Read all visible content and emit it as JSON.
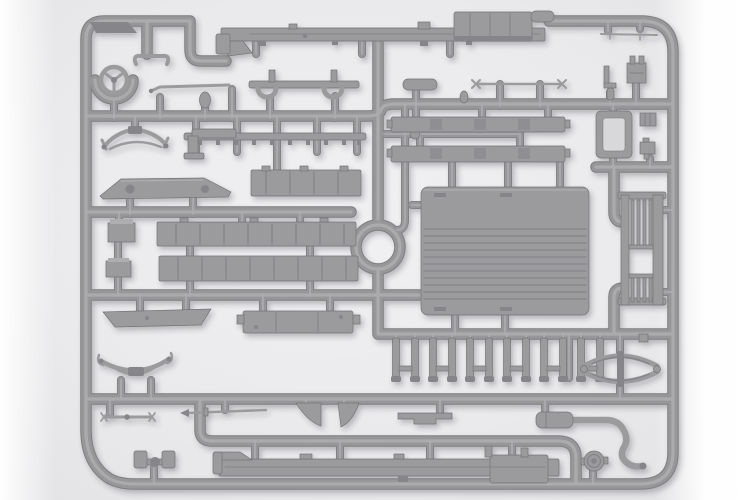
{
  "meta": {
    "title": "Model kit sprue — grey styrene parts frame (truck chassis details)",
    "type": "product-photo",
    "text_on_screen": "none"
  },
  "colors": {
    "runner-mid": "#97979a",
    "runner-edge": "#7e7e82",
    "runner-highlight": "#aeaeb1",
    "part": "#9b9b9e",
    "part-dark": "#85858a",
    "part-light": "#aeaeb0",
    "part-edge": "#747478",
    "hole": "#d8d8db",
    "background": "#eaeaec",
    "page": "#ffffff",
    "shadow": "rgba(50,50,60,0.28)"
  },
  "sprue": {
    "material": "grey injection-molded styrene",
    "stake_count": 12,
    "parts": [
      {
        "name": "sprue-frame",
        "label": "Rectangular runner frame with internal runners"
      },
      {
        "name": "steering-wheel",
        "label": "Steering wheel (3-spoke) in U-holder"
      },
      {
        "name": "control-lever",
        "label": "Control lever with curled ends"
      },
      {
        "name": "thin-rod-upper",
        "label": "Thin linkage rod"
      },
      {
        "name": "hook-bracket",
        "label": "Bracket strip with hanging hooks"
      },
      {
        "name": "small-oval",
        "label": "Small oval fitting"
      },
      {
        "name": "ladder-rail",
        "label": "Thin rail with tabs"
      },
      {
        "name": "l-bracket",
        "label": "L-shaped pedal bracket"
      },
      {
        "name": "front-leaf-spring",
        "label": "Curved leaf spring (front)"
      },
      {
        "name": "fender",
        "label": "Fender / mudguard plate with two holes"
      },
      {
        "name": "tool-box-1",
        "label": "Small storage box"
      },
      {
        "name": "tool-box-2",
        "label": "Small storage box"
      },
      {
        "name": "bed-side-short",
        "label": "Cargo bed side board (short)"
      },
      {
        "name": "bed-side-long-1",
        "label": "Cargo bed side board (long)"
      },
      {
        "name": "bed-side-long-2",
        "label": "Cargo bed side board (long)"
      },
      {
        "name": "bed-floor-panel",
        "label": "Cargo bed floor panel with plank grooves"
      },
      {
        "name": "radiator-frame",
        "label": "Open radiator shell frame"
      },
      {
        "name": "small-fitting-1",
        "label": "Small fitting"
      },
      {
        "name": "small-fitting-2",
        "label": "Small fitting with leg"
      },
      {
        "name": "tailgate-rack",
        "label": "Slatted tailgate / rack panel"
      },
      {
        "name": "stake-posts",
        "label": "Row of twelve stake posts"
      },
      {
        "name": "rear-leaf-spring",
        "label": "Elliptical leaf spring (rear)"
      },
      {
        "name": "left-leaf-spring",
        "label": "Curved leaf spring with shackles"
      },
      {
        "name": "step-plate",
        "label": "Running-board step plate"
      },
      {
        "name": "center-sill",
        "label": "Bench / sill box part"
      },
      {
        "name": "chassis-rail-upper",
        "label": "Chassis side rail (top of sprue)"
      },
      {
        "name": "fuel-tank-box",
        "label": "Fuel tank / muffler box"
      },
      {
        "name": "chassis-rail-lower",
        "label": "Chassis side rail (bottom of sprue)"
      },
      {
        "name": "gusset-pair",
        "label": "Two triangular gussets"
      },
      {
        "name": "notched-bracket",
        "label": "Flat notched bracket"
      },
      {
        "name": "tie-rod-left",
        "label": "Tie rod with forged ends"
      },
      {
        "name": "tie-rod-center",
        "label": "Thin rod with arrow end"
      },
      {
        "name": "axle-rod-right",
        "label": "Axle rod with cross finials"
      },
      {
        "name": "steering-cylinder",
        "label": "Small cylinder part"
      },
      {
        "name": "running-board-1",
        "label": "Running board plank"
      },
      {
        "name": "running-board-2",
        "label": "Running board plank"
      },
      {
        "name": "muffler-exhaust",
        "label": "Muffler with S-curved exhaust pipe"
      },
      {
        "name": "wheel-hub",
        "label": "Wheel hub / pulley disc"
      },
      {
        "name": "axle-pad-part",
        "label": "Axle mount with twin pads"
      },
      {
        "name": "top-right-rod",
        "label": "Thin rod with cross ticks"
      },
      {
        "name": "top-right-bracket",
        "label": "Small bracket and cylinder"
      },
      {
        "name": "top-right-box",
        "label": "Small box with posts"
      }
    ]
  }
}
